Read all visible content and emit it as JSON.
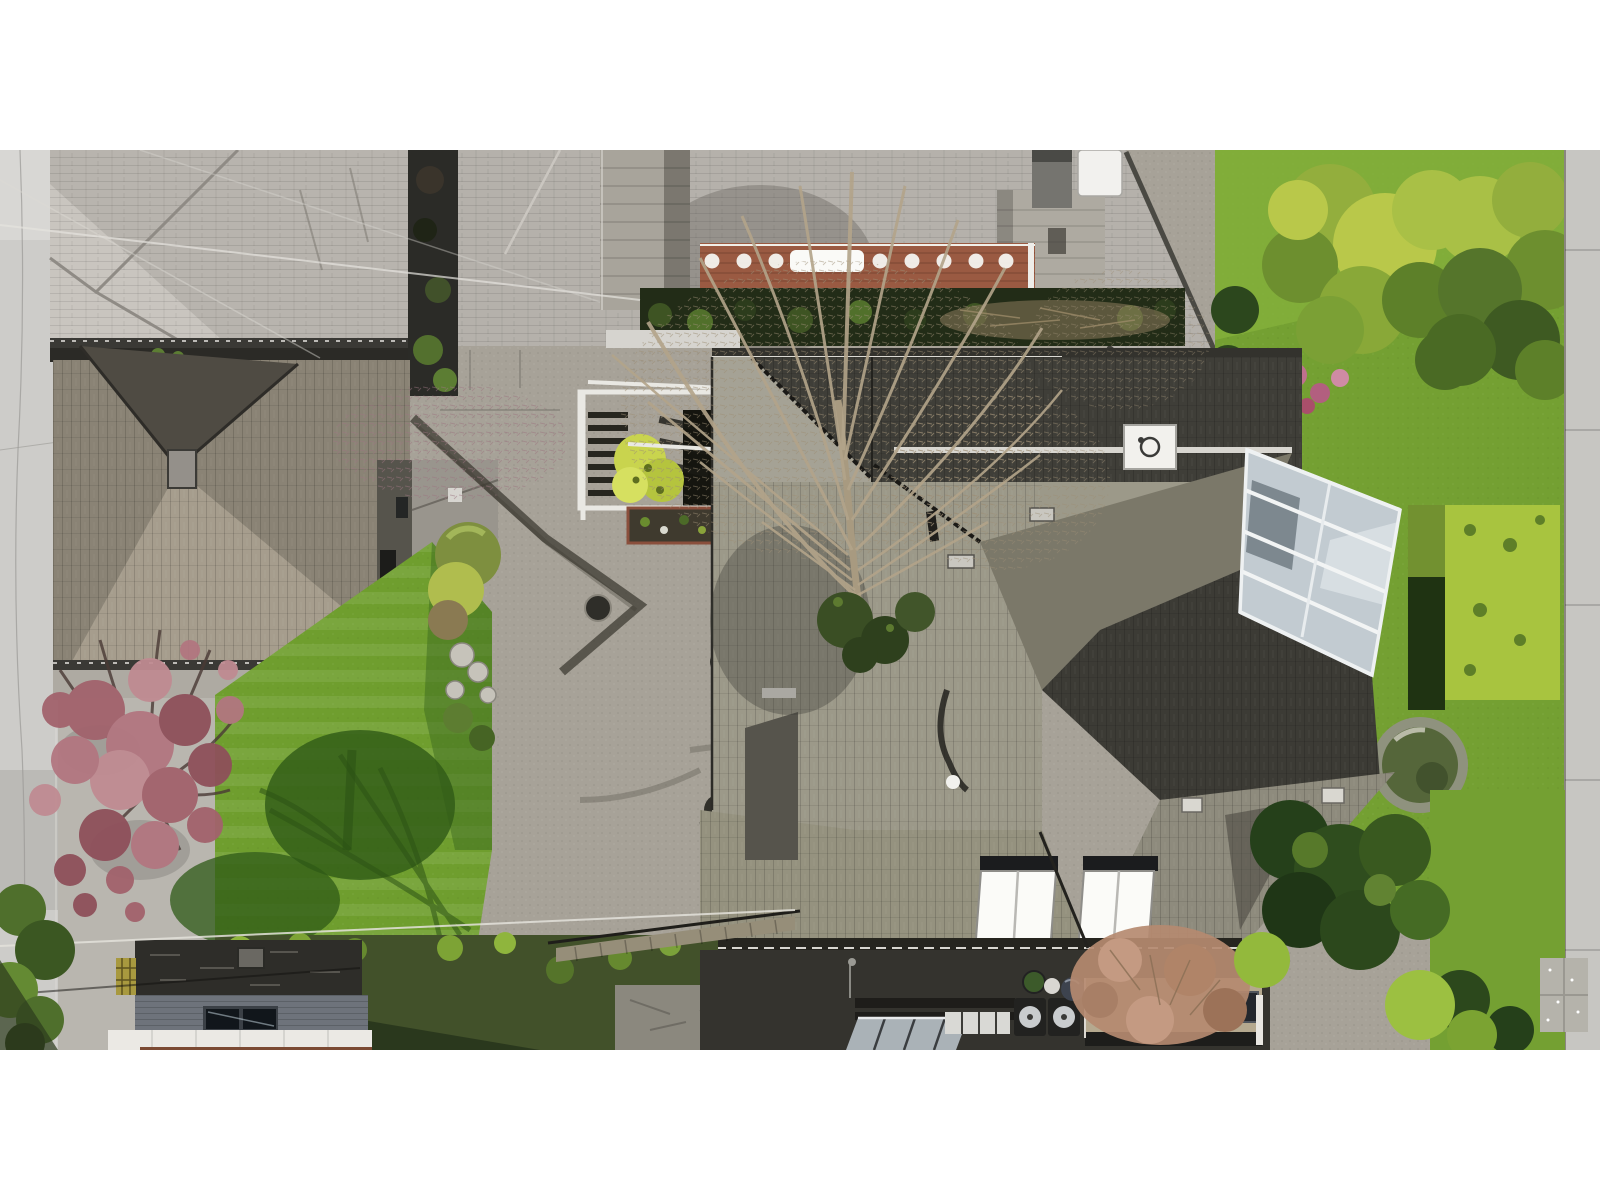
{
  "image": {
    "type": "aerial drone photograph, top-down (nadir) view",
    "subject": "two residential properties with weathered cedar-shake hip roofs, a landscaped courtyard garden, bright lawns, a white-framed glass conservatory, garage rooftops, street pavement on the left and a sidewalk on the right",
    "season_cues": "early spring: bare deciduous trees, pink blossom tree, fresh green lawns"
  },
  "palette": {
    "page_bg": "#ffffff",
    "road": "#cdccc9",
    "sidewalk": "#c7c6c2",
    "pavement": "#a7a298",
    "pavement_light": "#b9b6af",
    "roof_light": "#b8b4ae",
    "roof_light_sun": "#c9c5bf",
    "roof2": "#b5b1ab",
    "eave_dark": "#3a3935",
    "shake_base": "#8a8375",
    "shake_dark_tri": "#4f4b43",
    "shake_bright": "#a69d8d",
    "deck_brick": "#9a5a42",
    "hedge_dark": "#222c17",
    "stone_chimney": "#a8a49b",
    "stone_walk": "#aeaaa1",
    "main_dark": "#3f3e38",
    "main_light": "#a5a295",
    "main_bright": "#9c9989",
    "main_mid": "#7b7869",
    "main_diag_dark": "#3c3b35",
    "main_wing": "#8e8b7d",
    "main_bottom": "#95927f",
    "main_left_strip": "#56544c",
    "glass": "#c2cbd1",
    "skylight_white": "#fbfbf8",
    "lawn": "#6f9e2e",
    "lawn_shadow": "#2f5a17",
    "garden_lawn": "#74a032",
    "hedge_bright": "#a8c43f",
    "pond_stone": "#8f927e",
    "pond_water": "#55663a",
    "pink_tree": "#a2626c",
    "ivy_bank": "#42512a",
    "stone_wall_dark": "#2e2d29",
    "garage_deck": "#6e737b",
    "fascia_white": "#ebe9e4",
    "patio_stone": "#8b887e",
    "house_base_dark": "#34332e",
    "tan_roof": "#b5a98f",
    "hydrangea": "#b58a70",
    "dark_trees": "#25401a",
    "boardwalk": "#968e79",
    "urn": "#2f2e29",
    "umbrella_blue": "#8197b2"
  },
  "annotations": [
    {
      "name": "left-road",
      "desc": "light concrete street pavement along left edge"
    },
    {
      "name": "top-left-house-roof",
      "desc": "large weathered light-gray shake hip roof, top left"
    },
    {
      "name": "top-center-house",
      "desc": "neighboring roof with brick-red deck, white ornate railing, stone chimneys, white chimney cap"
    },
    {
      "name": "mid-left-house-roof",
      "desc": "brown-gray cedar shake pyramid hip roof with sunlit south face and chimney"
    },
    {
      "name": "main-house-roof",
      "desc": "large multi-tier shake roof with dark shadowed faces, white trim lines, white vent box, two bright skylights"
    },
    {
      "name": "conservatory",
      "desc": "white-framed glass sunroom projecting from the east side"
    },
    {
      "name": "center-lawn",
      "desc": "bright striped lawn with tree shadows"
    },
    {
      "name": "courtyard",
      "desc": "exposed-aggregate paving, stair pergola with white rails, yellow tree, flower bed, round bushes and rockery"
    },
    {
      "name": "pink-blossom-tree",
      "desc": "purple-leaf plum tree lower left"
    },
    {
      "name": "bare-tree",
      "desc": "large leafless tree canopy over the center rooftops"
    },
    {
      "name": "right-garden",
      "desc": "lawns, clipped yellow-green hedges, magnolia, round stone pond, dark conifers"
    },
    {
      "name": "right-sidewalk",
      "desc": "concrete sidewalk strip along right edge"
    },
    {
      "name": "bottom-strip",
      "desc": "ivy bank, wood boardwalk, stone patio, garage roof deck with twin skylights, white fascia, AC fans, tan flat roof"
    },
    {
      "name": "power-lines",
      "desc": "thin utility cables crossing upper-left and lower-left"
    }
  ]
}
